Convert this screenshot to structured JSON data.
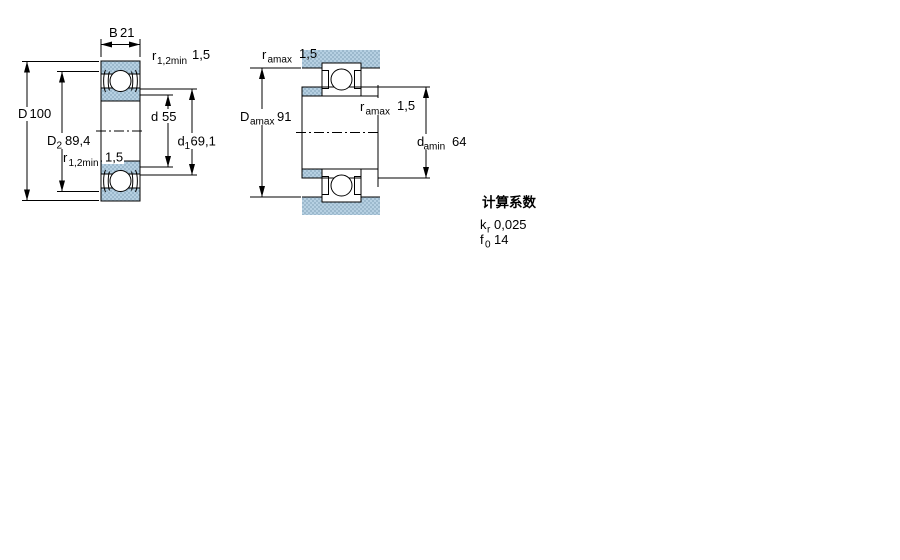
{
  "drawing": {
    "left_view": {
      "B": {
        "label": "B",
        "value": "21"
      },
      "D": {
        "label": "D",
        "value": "100"
      },
      "D2": {
        "label": "D",
        "sub": "2",
        "value": "89,4"
      },
      "r12_top": {
        "label": "r",
        "sub": "1,2min",
        "value": "1,5"
      },
      "r12_bottom": {
        "label": "r",
        "sub": "1,2min",
        "value": "1,5"
      },
      "d": {
        "label": "d",
        "value": "55"
      },
      "d1": {
        "label": "d",
        "sub": "1",
        "value": "69,1"
      }
    },
    "right_view": {
      "ra_top": {
        "label": "r",
        "sub": "amax",
        "value": "1,5"
      },
      "Da_max": {
        "label": "D",
        "sub": "amax",
        "value": "91"
      },
      "ra_mid": {
        "label": "r",
        "sub": "amax",
        "value": "1,5"
      },
      "da_min": {
        "label": "d",
        "sub": "amin",
        "value": "64"
      }
    },
    "colors": {
      "hatch_light": "#b6d0e2",
      "hatch_dark": "#9cb9cd",
      "line": "#000000"
    }
  },
  "calc_factors": {
    "title": "计算系数",
    "rows": [
      {
        "label": "k",
        "sub": "r",
        "value": "0,025"
      },
      {
        "label": "f",
        "sub": "0",
        "value": "14"
      }
    ]
  }
}
